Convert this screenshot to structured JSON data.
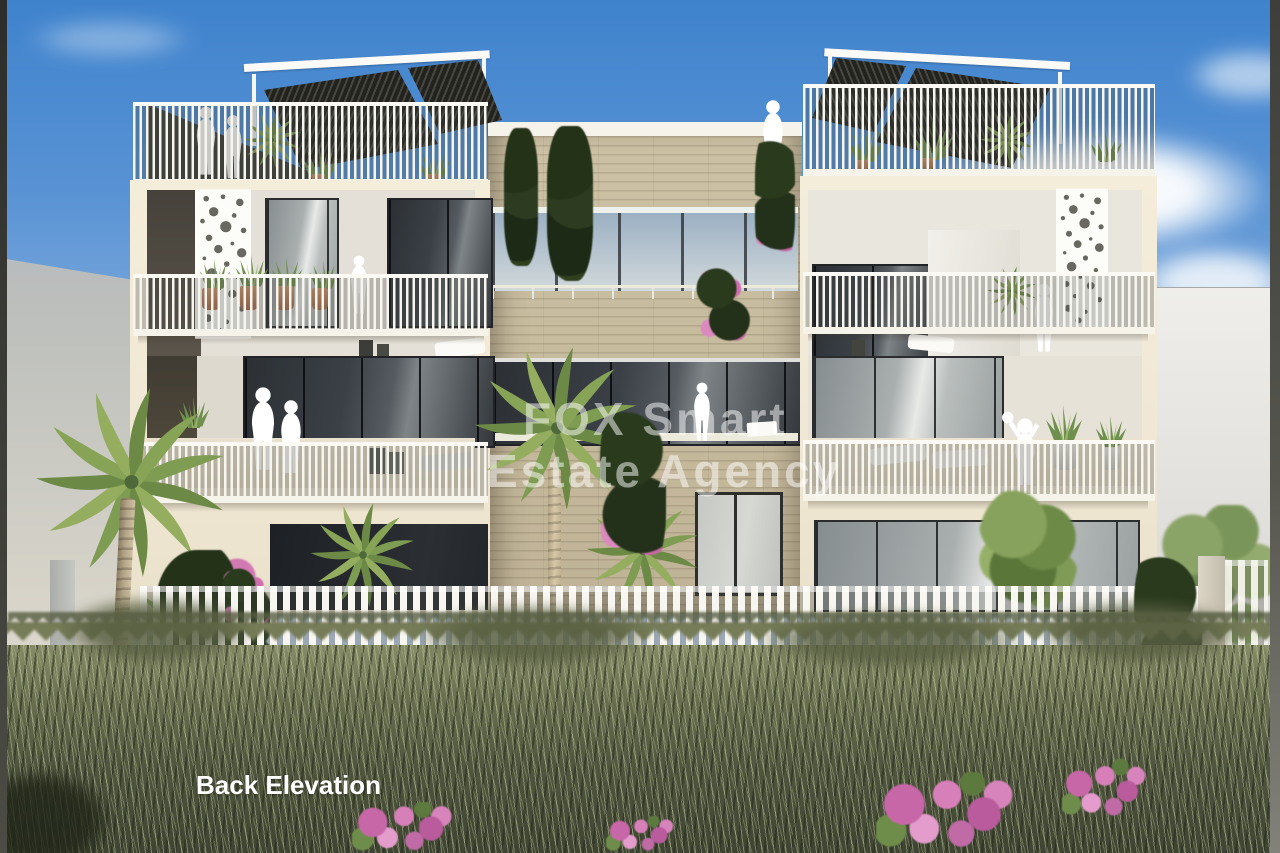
{
  "scene": {
    "type": "3D architectural rendering of a three-storey apartment building, rear view",
    "caption": "Back Elevation",
    "watermark": {
      "line1": "FOX Smart",
      "line2": "Estate Agency"
    }
  },
  "colors": {
    "sky_top": "#3f83cd",
    "sky_horizon": "#d9e2ee",
    "facade_cream": "#f1e9d5",
    "stone_cladding": "#c7bb9f",
    "railing_white": "#f8f6f1",
    "pergola_dark": "#2b2b26",
    "glass_dark": "#363b41",
    "glass_sky_reflection": "#aabdcd",
    "grass_dark": "#3e4431",
    "grass_light": "#b9bf98",
    "bougainvillea_pink": "#d177b0",
    "palm_green": "#7e9c52",
    "frame_edge_dark": "#3a3a38",
    "neighbor_wall_gray": "#c3c4c0",
    "watermark_white": "rgba(255,255,255,0.5)"
  }
}
